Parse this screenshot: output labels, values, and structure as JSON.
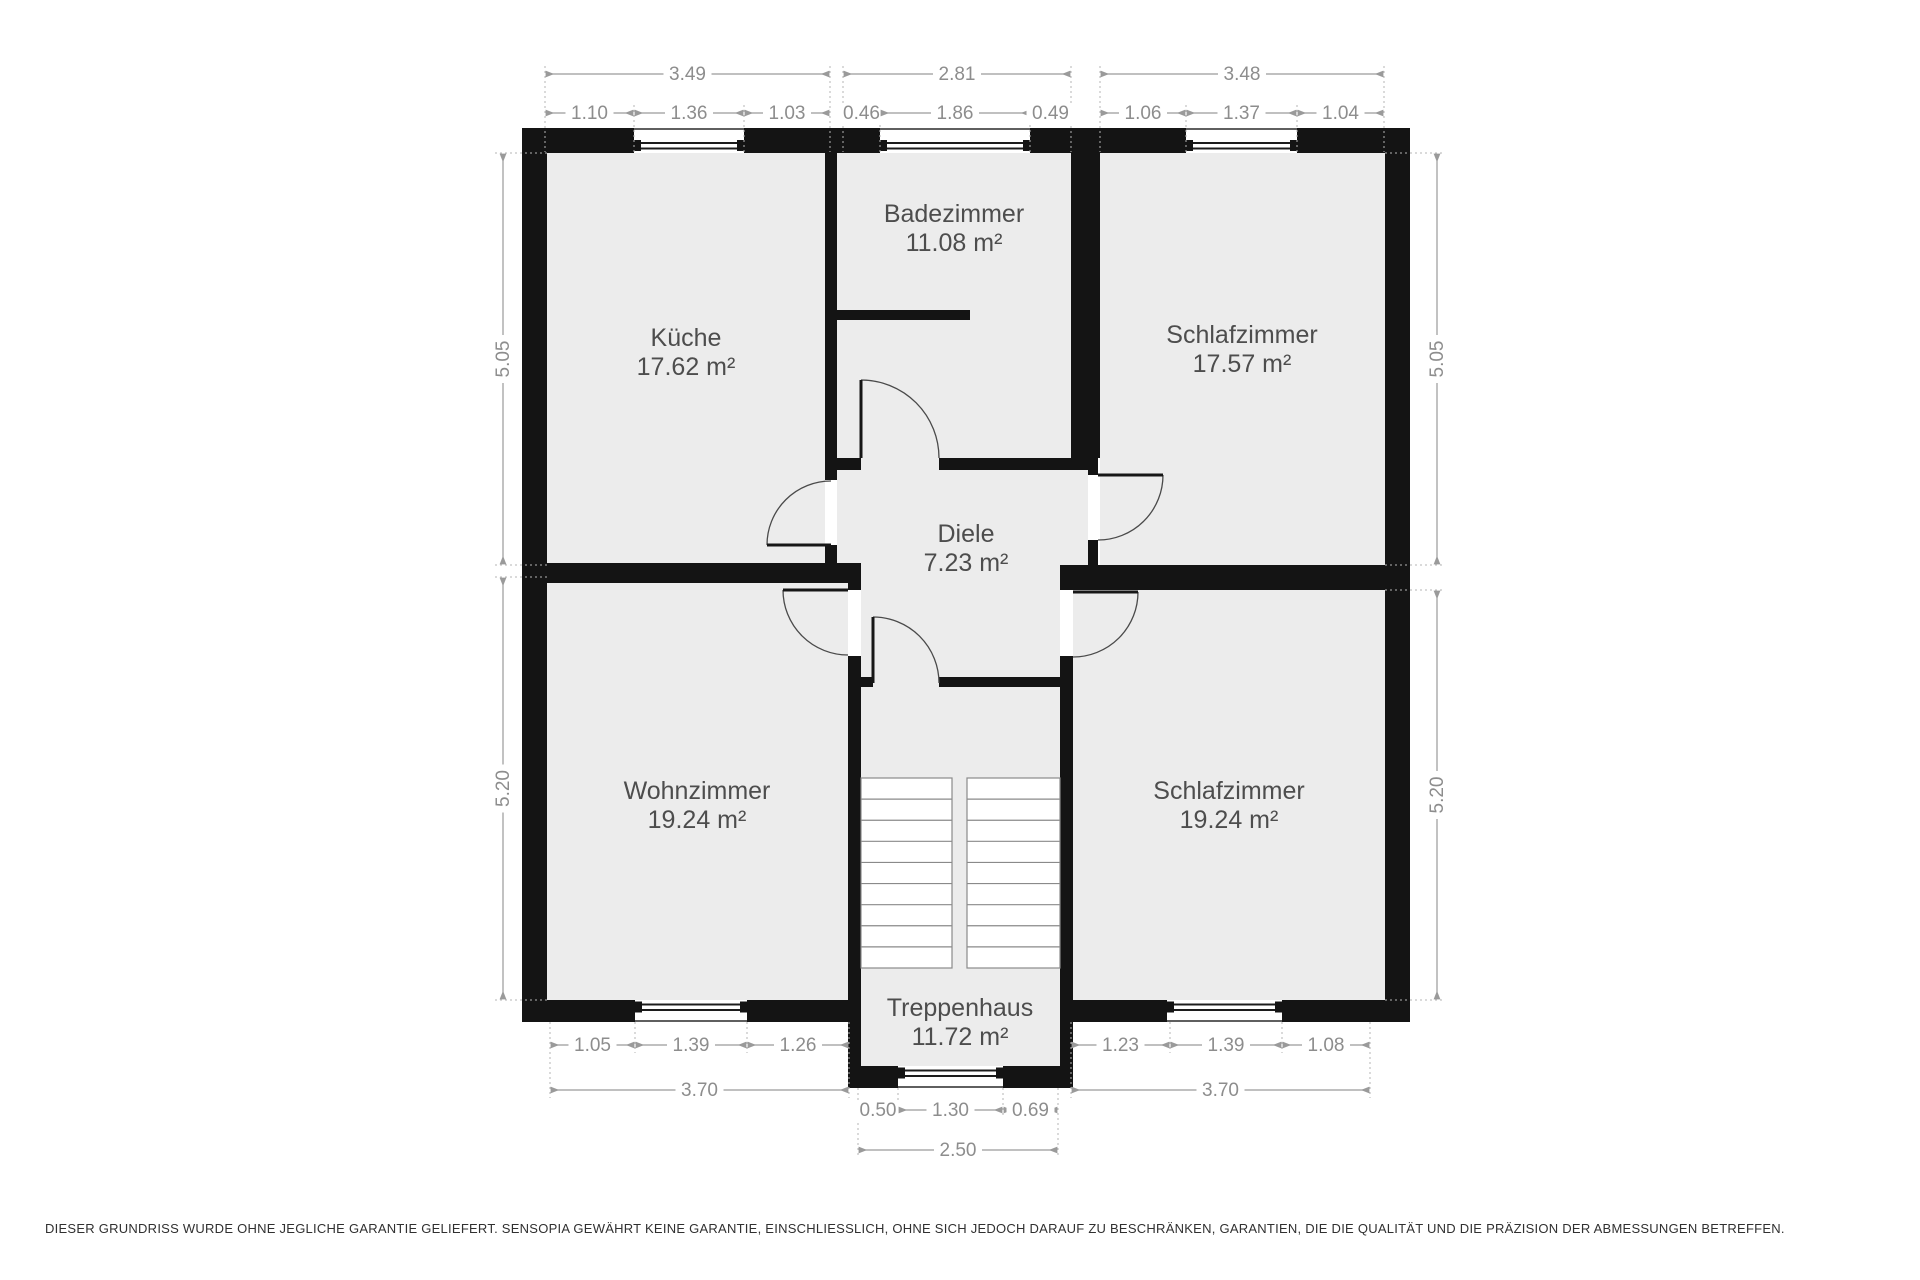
{
  "title": "Grundriss (floor plan)",
  "colors": {
    "background": "#ffffff",
    "floor": "#ececec",
    "wall": "#141414",
    "dim_line": "#9a9a9a",
    "dim_text": "#8d8d8d",
    "room_text": "#4d4d4d",
    "door_arc": "#4a4a4a",
    "stair_line": "#8a8a8a"
  },
  "rooms": [
    {
      "id": "kueche",
      "name": "Küche",
      "area": "17.62 m²",
      "cx": 686,
      "cy": 352
    },
    {
      "id": "badezimmer",
      "name": "Badezimmer",
      "area": "11.08 m²",
      "cx": 954,
      "cy": 228
    },
    {
      "id": "schlafzimmer-1",
      "name": "Schlafzimmer",
      "area": "17.57 m²",
      "cx": 1242,
      "cy": 349
    },
    {
      "id": "diele",
      "name": "Diele",
      "area": "7.23 m²",
      "cx": 966,
      "cy": 548
    },
    {
      "id": "wohnzimmer",
      "name": "Wohnzimmer",
      "area": "19.24 m²",
      "cx": 697,
      "cy": 805
    },
    {
      "id": "schlafzimmer-2",
      "name": "Schlafzimmer",
      "area": "19.24 m²",
      "cx": 1229,
      "cy": 805
    },
    {
      "id": "treppenhaus",
      "name": "Treppenhaus",
      "area": "11.72 m²",
      "cx": 960,
      "cy": 1022
    }
  ],
  "dimensions_horizontal": [
    {
      "v": "3.49",
      "x1": 545,
      "x2": 830,
      "y": 74
    },
    {
      "v": "2.81",
      "x1": 843,
      "x2": 1071,
      "y": 74
    },
    {
      "v": "3.48",
      "x1": 1100,
      "x2": 1384,
      "y": 74
    },
    {
      "v": "1.10",
      "x1": 545,
      "x2": 634,
      "y": 113
    },
    {
      "v": "1.36",
      "x1": 634,
      "x2": 744,
      "y": 113
    },
    {
      "v": "1.03",
      "x1": 744,
      "x2": 830,
      "y": 113
    },
    {
      "v": "0.46",
      "x1": 843,
      "x2": 880,
      "y": 113
    },
    {
      "v": "1.86",
      "x1": 880,
      "x2": 1030,
      "y": 113
    },
    {
      "v": "0.49",
      "x1": 1030,
      "x2": 1071,
      "y": 113
    },
    {
      "v": "1.06",
      "x1": 1100,
      "x2": 1186,
      "y": 113
    },
    {
      "v": "1.37",
      "x1": 1186,
      "x2": 1297,
      "y": 113
    },
    {
      "v": "1.04",
      "x1": 1297,
      "x2": 1384,
      "y": 113
    },
    {
      "v": "1.05",
      "x1": 550,
      "x2": 635,
      "y": 1045
    },
    {
      "v": "1.39",
      "x1": 635,
      "x2": 747,
      "y": 1045
    },
    {
      "v": "1.26",
      "x1": 747,
      "x2": 849,
      "y": 1045
    },
    {
      "v": "1.23",
      "x1": 1071,
      "x2": 1170,
      "y": 1045
    },
    {
      "v": "1.39",
      "x1": 1170,
      "x2": 1282,
      "y": 1045
    },
    {
      "v": "1.08",
      "x1": 1282,
      "x2": 1370,
      "y": 1045
    },
    {
      "v": "3.70",
      "x1": 550,
      "x2": 849,
      "y": 1090
    },
    {
      "v": "3.70",
      "x1": 1071,
      "x2": 1370,
      "y": 1090
    },
    {
      "v": "0.50",
      "x1": 858,
      "x2": 898,
      "y": 1110
    },
    {
      "v": "1.30",
      "x1": 898,
      "x2": 1003,
      "y": 1110
    },
    {
      "v": "0.69",
      "x1": 1003,
      "x2": 1058,
      "y": 1110
    },
    {
      "v": "2.50",
      "x1": 858,
      "x2": 1058,
      "y": 1150
    }
  ],
  "dimensions_vertical": [
    {
      "v": "5.05",
      "x": 503,
      "y1": 153,
      "y2": 565
    },
    {
      "v": "5.20",
      "x": 503,
      "y1": 577,
      "y2": 1000
    },
    {
      "v": "5.05",
      "x": 1437,
      "y1": 153,
      "y2": 565
    },
    {
      "v": "5.20",
      "x": 1437,
      "y1": 590,
      "y2": 1000
    }
  ],
  "extensions_vertical": [
    [
      545,
      66,
      152
    ],
    [
      830,
      66,
      152
    ],
    [
      843,
      66,
      152
    ],
    [
      1071,
      66,
      152
    ],
    [
      1100,
      66,
      152
    ],
    [
      1384,
      66,
      152
    ],
    [
      634,
      105,
      152
    ],
    [
      744,
      105,
      152
    ],
    [
      880,
      105,
      152
    ],
    [
      1030,
      105,
      152
    ],
    [
      1186,
      105,
      152
    ],
    [
      1297,
      105,
      152
    ],
    [
      635,
      1022,
      1053
    ],
    [
      747,
      1022,
      1053
    ],
    [
      1170,
      1022,
      1053
    ],
    [
      1282,
      1022,
      1053
    ],
    [
      550,
      1022,
      1098
    ],
    [
      849,
      1022,
      1098
    ],
    [
      1071,
      1022,
      1098
    ],
    [
      1370,
      1022,
      1098
    ],
    [
      898,
      1088,
      1118
    ],
    [
      1003,
      1088,
      1118
    ],
    [
      858,
      1088,
      1158
    ],
    [
      1058,
      1088,
      1158
    ]
  ],
  "extensions_horizontal": [
    [
      153,
      495,
      547
    ],
    [
      565,
      495,
      547
    ],
    [
      577,
      495,
      547
    ],
    [
      1000,
      495,
      547
    ],
    [
      153,
      1385,
      1445
    ],
    [
      565,
      1385,
      1445
    ],
    [
      590,
      1385,
      1445
    ],
    [
      1000,
      1385,
      1445
    ]
  ],
  "stairs": {
    "flights": 2,
    "treads_per_flight": 9
  },
  "disclaimer": "DIESER GRUNDRISS WURDE OHNE JEGLICHE GARANTIE GELIEFERT. SENSOPIA GEWÄHRT KEINE GARANTIE, EINSCHLIESSLICH, OHNE SICH JEDOCH DARAUF ZU BESCHRÄNKEN, GARANTIEN, DIE DIE QUALITÄT UND DIE PRÄZISION DER ABMESSUNGEN BETREFFEN."
}
